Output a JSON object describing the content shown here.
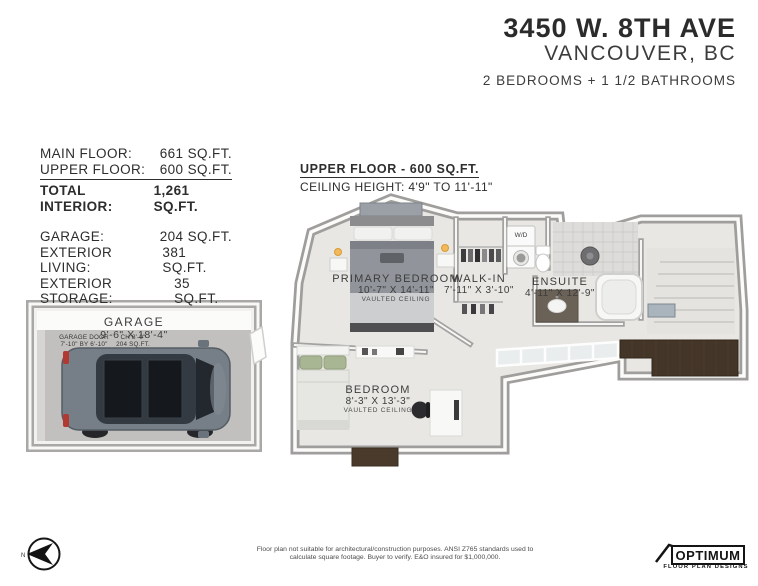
{
  "header": {
    "address": "3450 W. 8TH AVE",
    "city": "VANCOUVER, BC",
    "subtitle": "2 BEDROOMS + 1 1/2 BATHROOMS"
  },
  "stats": {
    "main": {
      "label": "MAIN FLOOR:",
      "value": "661 SQ.FT."
    },
    "upper": {
      "label": "UPPER FLOOR:",
      "value": "600 SQ.FT."
    },
    "total": {
      "label": "TOTAL INTERIOR:",
      "value": "1,261 SQ.FT."
    },
    "garage": {
      "label": "GARAGE:",
      "value": "204 SQ.FT."
    },
    "ext_living": {
      "label": "EXTERIOR LIVING:",
      "value": "381 SQ.FT."
    },
    "ext_storage": {
      "label": "EXTERIOR STORAGE:",
      "value": "35 SQ.FT."
    }
  },
  "floor": {
    "title": "UPPER FLOOR - 600 SQ.FT.",
    "ceiling": "CEILING HEIGHT: 4'9\" TO 11'-11\""
  },
  "rooms": {
    "primary": {
      "name": "PRIMARY BEDROOM",
      "dims": "10'-7\" X 14'-11\"",
      "note": "VAULTED CEILING"
    },
    "walkin": {
      "name": "WALK-IN",
      "dims": "7'-11\" X 3'-10\""
    },
    "ensuite": {
      "name": "ENSUITE",
      "dims": "4'-11\" X 12'-9\""
    },
    "bedroom": {
      "name": "BEDROOM",
      "dims": "8'-3\" X 13'-3\"",
      "note": "VAULTED CEILING"
    },
    "wd": "W/D"
  },
  "garage": {
    "name": "GARAGE",
    "dims": "9'-6\" X 18'-4\"",
    "door_label": "GARAGE DOOR",
    "door_dims": "7'-10\" BY 6'-10\"",
    "ch": "CH 8'-0\"",
    "area": "204 SQ.FT."
  },
  "footer": {
    "disclaimer1": "Floor plan not suitable for architectural/construction purposes. ANSI Z765 standards used to",
    "disclaimer2": "calculate square footage. Buyer to verify.  E&O insured for $1,000,000.",
    "logo_name": "OPTIMUM",
    "logo_sub": "FLOOR PLAN DESIGNS",
    "compass_n": "N"
  },
  "colors": {
    "carpet": "#e8e7e3",
    "wall_gray": "#9f9e9c",
    "wood_dark": "#433527",
    "accent_text": "#2b2b2b",
    "car_body": "#767f87",
    "lamp_glow": "#f0b95c",
    "pillow_green": "#a9b694"
  }
}
